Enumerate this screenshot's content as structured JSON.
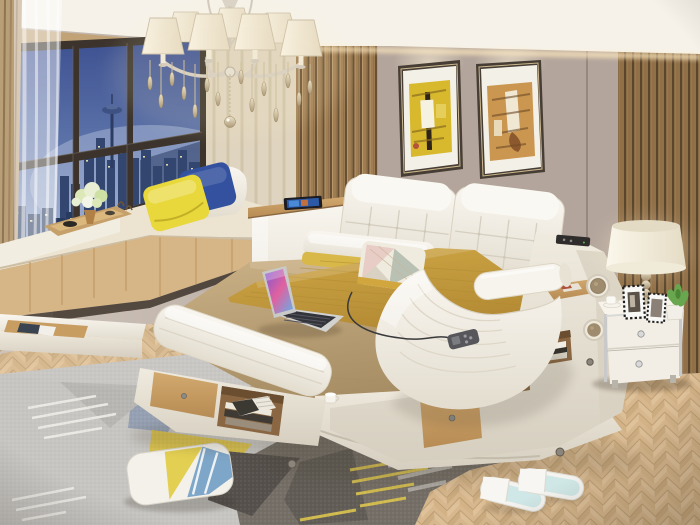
{
  "scene": {
    "description": "Photo-style render of a modern bedroom: multifunctional white leather smart bed with tan bedding, open laptop and massage chaise, corner bay window with dusk city skyline and Space Needle, crystal chandelier, two abstract framed paintings on a taupe wall, wood slat panels, white nightstand with table lamp and plant, geometric grey area rug with a throw pillow on herringbone oak flooring, and a pair of white slippers.",
    "objects": [
      "chandelier",
      "bay-window",
      "city-skyline",
      "sheer-curtain",
      "window-seat",
      "flower-tray",
      "throw-pillow-yellow",
      "throw-pillow-blue",
      "painting-left",
      "painting-right",
      "wood-slat-panel-left",
      "wood-slat-panel-right",
      "smart-bed",
      "headboard",
      "bed-pillows",
      "laptop",
      "mustard-runner",
      "massage-chaise",
      "remote-control",
      "storage-bench",
      "side-shelves",
      "speaker-grille",
      "nightstand",
      "table-lamp",
      "potted-plant",
      "picture-frames",
      "area-rug",
      "floor-pillow",
      "slippers",
      "herringbone-floor"
    ]
  },
  "palette": {
    "wall": "#b3a59b",
    "ceiling": "#f6f2ea",
    "cove_glow": "#ffe9c0",
    "slat_wood": "#ab865a",
    "slat_groove": "#6f5638",
    "slat_dark": "#9c7a4e",
    "curtain_tan": "#b99f78",
    "curtain_cream": "#e9dfcb",
    "window_frame": "#3b332c",
    "sky_top": "#3e5292",
    "sky_bottom": "#8ea1c9",
    "city": "#33466f",
    "city_lights": "#f2e8b4",
    "cushion_cream": "#ece3d1",
    "pillow_yellow": "#e8d83c",
    "pillow_blue": "#33519e",
    "leather_white": "#f6f3ea",
    "leather_shadow": "#ddd6c6",
    "sheet_khaki": "#c0a678",
    "runner_mustard": "#c59e3e",
    "wood_light": "#c89d62",
    "wood_dark": "#8a6742",
    "floor_light": "#dcc09b",
    "floor_dark": "#cfb086",
    "rug_base": "#c7c5c1",
    "rug_dark": "#746e66",
    "rug_yellow": "#d8c14e",
    "rug_blue": "#95a0b2",
    "rug_charcoal": "#55504b",
    "rug_purple": "#6e6880",
    "rug_white": "#edebe6",
    "nightstand": "#f2eee5",
    "chrome": "#c9c9c9",
    "lamp_shade": "#f8f3e6",
    "plant_green": "#69a74e",
    "slipper": "#f4f3ef",
    "slipper_insole": "#cfe7e6",
    "laptop_silver": "#d2d2d0",
    "remote_gray": "#57575b",
    "painting_yellow": "#d8b92e",
    "painting_orange": "#cb9750",
    "frame_dark": "#463d34"
  }
}
